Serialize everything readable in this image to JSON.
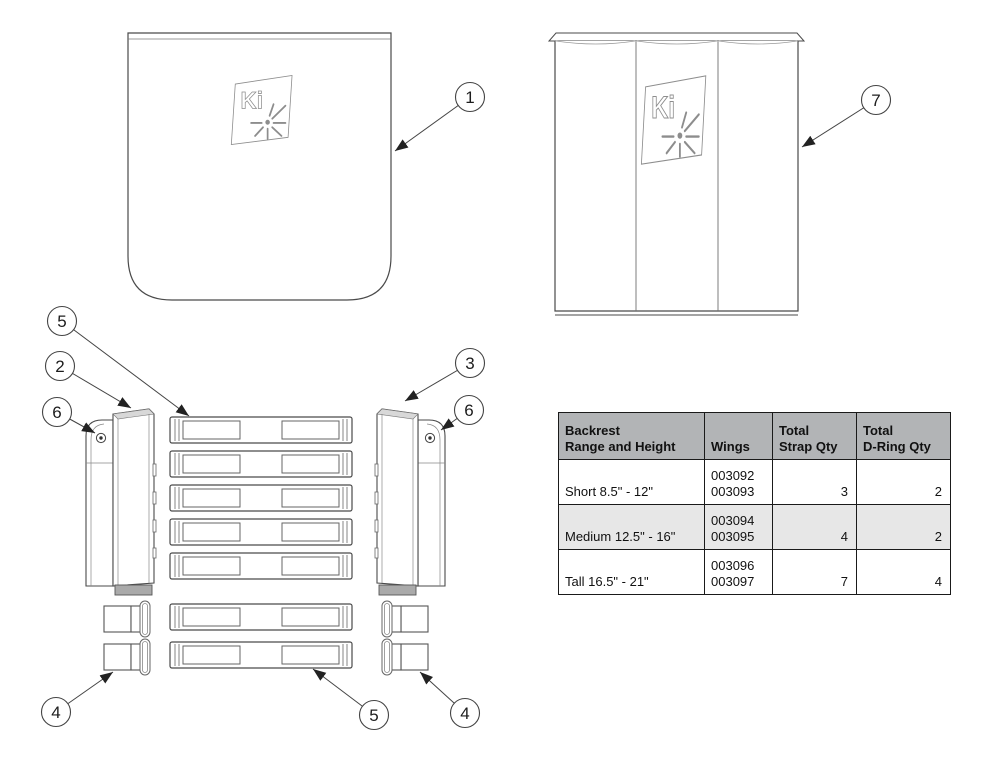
{
  "diagram": {
    "logo_text": "Ki",
    "callouts": {
      "cover_back": "1",
      "wing_left": "2",
      "wing_right": "3",
      "dring_left": "4",
      "dring_right": "4",
      "strap_upper": "5",
      "strap_lower": "5",
      "screw_left": "6",
      "screw_right": "6",
      "cover_shell": "7"
    }
  },
  "table": {
    "headers": {
      "range_line1": "Backrest",
      "range_line2": "Range and Height",
      "wings": "Wings",
      "strap_line1": "Total",
      "strap_line2": "Strap Qty",
      "dring_line1": "Total",
      "dring_line2": "D-Ring Qty"
    },
    "rows": [
      {
        "range": "Short 8.5\" - 12\"",
        "wings_a": "003092",
        "wings_b": "003093",
        "strap_qty": "3",
        "dring_qty": "2"
      },
      {
        "range": "Medium 12.5\" - 16\"",
        "wings_a": "003094",
        "wings_b": "003095",
        "strap_qty": "4",
        "dring_qty": "2"
      },
      {
        "range": "Tall 16.5\" - 21\"",
        "wings_a": "003096",
        "wings_b": "003097",
        "strap_qty": "7",
        "dring_qty": "4"
      }
    ],
    "colors": {
      "header_bg": "#b2b4b6",
      "alt_row_bg": "#e7e7e7",
      "border": "#1a1a1a"
    }
  }
}
